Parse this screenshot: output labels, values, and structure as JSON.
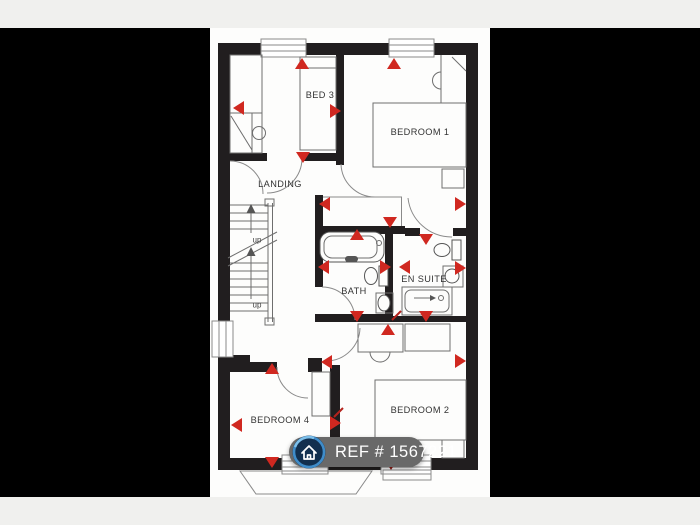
{
  "colors": {
    "page_bg": "#f0f0ee",
    "side_bars": "#000000",
    "plan_strip": "#fdfdfc",
    "wall": "#211e1f",
    "marker_red": "#d02820",
    "marker_dark_red": "#8f1b15",
    "banner_bg": "#696969",
    "banner_text": "#ffffff",
    "icon_ring_blue": "#3f8cc9",
    "icon_fill_navy": "#122f4e"
  },
  "floorplan": {
    "room_labels": {
      "bed3": "BED 3",
      "bedroom1": "BEDROOM 1",
      "landing": "LANDING",
      "bath": "BATH",
      "en_suite": "EN SUITE",
      "bedroom4": "BEDROOM 4",
      "bedroom2": "BEDROOM 2"
    },
    "stairs": {
      "up_label_1": "up",
      "up_label_2": "up"
    },
    "markers": [
      {
        "x": 302,
        "y": 58,
        "d": "up"
      },
      {
        "x": 394,
        "y": 58,
        "d": "up"
      },
      {
        "x": 233,
        "y": 108,
        "d": "left"
      },
      {
        "x": 341,
        "y": 111,
        "d": "right"
      },
      {
        "x": 303,
        "y": 163,
        "d": "down"
      },
      {
        "x": 466,
        "y": 204,
        "d": "right"
      },
      {
        "x": 319,
        "y": 204,
        "d": "left"
      },
      {
        "x": 390,
        "y": 228,
        "d": "down"
      },
      {
        "x": 357,
        "y": 229,
        "d": "up"
      },
      {
        "x": 426,
        "y": 245,
        "d": "down"
      },
      {
        "x": 318,
        "y": 267,
        "d": "left"
      },
      {
        "x": 391,
        "y": 267,
        "d": "right"
      },
      {
        "x": 399,
        "y": 267,
        "d": "left"
      },
      {
        "x": 466,
        "y": 268,
        "d": "right"
      },
      {
        "x": 357,
        "y": 322,
        "d": "down"
      },
      {
        "x": 426,
        "y": 322,
        "d": "down"
      },
      {
        "x": 388,
        "y": 324,
        "d": "up",
        "tail": [
          392,
          320,
          401,
          311
        ]
      },
      {
        "x": 321,
        "y": 362,
        "d": "left"
      },
      {
        "x": 272,
        "y": 363,
        "d": "up"
      },
      {
        "x": 231,
        "y": 425,
        "d": "left"
      },
      {
        "x": 341,
        "y": 423,
        "d": "right",
        "tail": [
          334,
          417,
          343,
          408
        ]
      },
      {
        "x": 272,
        "y": 468,
        "d": "down"
      },
      {
        "x": 391,
        "y": 470,
        "d": "down",
        "dark": true
      },
      {
        "x": 466,
        "y": 361,
        "d": "right"
      }
    ]
  },
  "banner": {
    "ref_text": "REF # 1567221"
  }
}
